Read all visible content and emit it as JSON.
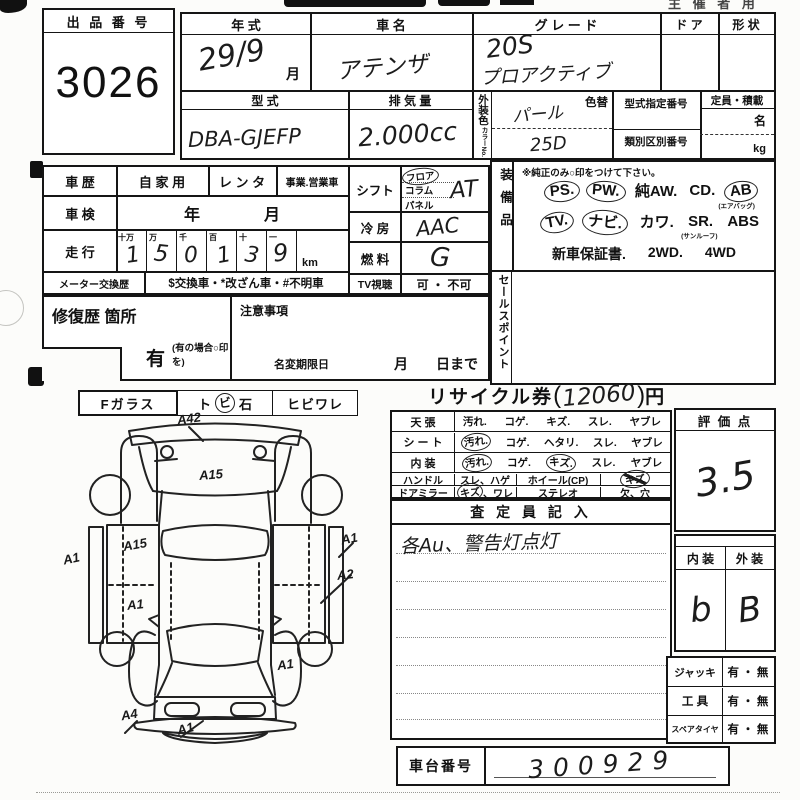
{
  "sheet": {
    "top_note_right": "主 催 者 用",
    "auction": {
      "label": "出 品 番 号",
      "value": "3026"
    },
    "head": {
      "year_label": "年    式",
      "year_value": "29/9",
      "month": "月",
      "name_label": "車    名",
      "name_value": "アテンザ",
      "grade_label": "グ レ ー ド",
      "grade1": "20S",
      "grade2": "プロアクティブ",
      "door_label": "ド ア",
      "shape_label": "形 状",
      "model_label": "型    式",
      "model_value": "DBA-GJEFP",
      "disp_label": "排 気 量",
      "disp_value": "2.000cc",
      "color_label": "外装色",
      "color_no_label": "カラーNo.",
      "color_value": "パール",
      "color_no_value": "25D",
      "color_change": "色替",
      "desig_label": "型式指定番号",
      "class_label": "類別区別番号",
      "cap_label": "定員・積載",
      "cap_people": "名",
      "cap_kg": "kg"
    },
    "hist": {
      "label": "車 歴",
      "opt1": "自 家 用",
      "opt2": "レ ン タ",
      "opt3": "事業.営業車",
      "shaken_label": "車 検",
      "shaken_value": "年　　　　月",
      "run_label": "走 行",
      "digits_headers": [
        "十万",
        "万",
        "千",
        "百",
        "十",
        "一"
      ],
      "digits": [
        "1",
        "5",
        "0",
        "1",
        "3",
        "9"
      ],
      "unit": "km",
      "meter_label": "メーター交換歴",
      "meter_value": "$交換車・*改ざん車・#不明車"
    },
    "repair": {
      "label": "修復歴  箇所",
      "yes": "有",
      "note": "(有の場合○印を)"
    },
    "caution": {
      "label": "注意事項",
      "namechange": "名変期限日",
      "until": "月　　日まで"
    },
    "ctrl": {
      "shift_label": "シフト",
      "shift1": "フロア",
      "shift2": "コラム",
      "shift3": "パネル",
      "shift_value": "AT",
      "ac_label": "冷  房",
      "ac_value": "AAC",
      "fuel_label": "燃  料",
      "fuel_value": "G",
      "tv_label": "TV視聴",
      "tv_value": "可 ・ 不可"
    },
    "equip": {
      "label": "装備品",
      "note": "※純正のみ○印をつけて下さい。",
      "r1": [
        "PS.",
        "PW.",
        "純AW.",
        "CD.",
        "AB"
      ],
      "r1sub": "(エアバッグ)",
      "r2": [
        "TV.",
        "ナビ.",
        "カワ.",
        "SR.",
        "ABS"
      ],
      "r2sub": "(サンルーフ)",
      "r3": [
        "新車保証書.",
        "2WD.",
        "4WD"
      ]
    },
    "sales_label": "セールスポイント",
    "glass": {
      "label": "Fガラス",
      "p1": "ト",
      "p2": "ビ",
      "p3": "石",
      "p4": "ヒビワレ"
    },
    "recycle": {
      "label": "リサイクル券",
      "open": "(",
      "value": "12060",
      "close": ")",
      "yen": "円"
    },
    "cond": {
      "rows": [
        {
          "label": "天    張",
          "opts": [
            "汚れ.",
            "コゲ.",
            "キズ.",
            "スレ.",
            "ヤブレ"
          ]
        },
        {
          "label": "シ ー ト",
          "opts": [
            "汚れ.",
            "コゲ.",
            "ヘタリ.",
            "スレ.",
            "ヤブレ"
          ]
        },
        {
          "label": "内    装",
          "opts": [
            "汚れ.",
            "コゲ.",
            "キズ.",
            "スレ.",
            "ヤブレ"
          ]
        }
      ],
      "handle_label": "ハンドル",
      "handle_opts": "スレ、ハゲ",
      "wheel_label": "ホイール(CP)",
      "wheel_val": "キズ",
      "mirror_label": "ドアミラー",
      "mirror_opt_a": "キズ",
      "mirror_opt_b": "、ワレ",
      "stereo_label": "ステレオ",
      "stereo_val": "欠、穴"
    },
    "assessor": {
      "header": "査  定  員  記  入",
      "note": "各Au、警告灯点灯"
    },
    "score": {
      "label": "評  価  点",
      "value": "3.5"
    },
    "grades": {
      "in_label": "内 装",
      "out_label": "外 装",
      "in_value": "b",
      "out_value": "B"
    },
    "acc": [
      {
        "label": "ジャッキ",
        "value": "有 ・ 無"
      },
      {
        "label": "工    具",
        "value": "有 ・ 無"
      },
      {
        "label": "スペアタイヤ",
        "value": "有 ・ 無"
      }
    ],
    "chassis": {
      "label": "車台番号",
      "value": "300929"
    },
    "diagram": {
      "marks": [
        "A42",
        "A15",
        "A15",
        "A1",
        "A1",
        "A1",
        "A2",
        "A1",
        "A4",
        "A1"
      ]
    }
  }
}
